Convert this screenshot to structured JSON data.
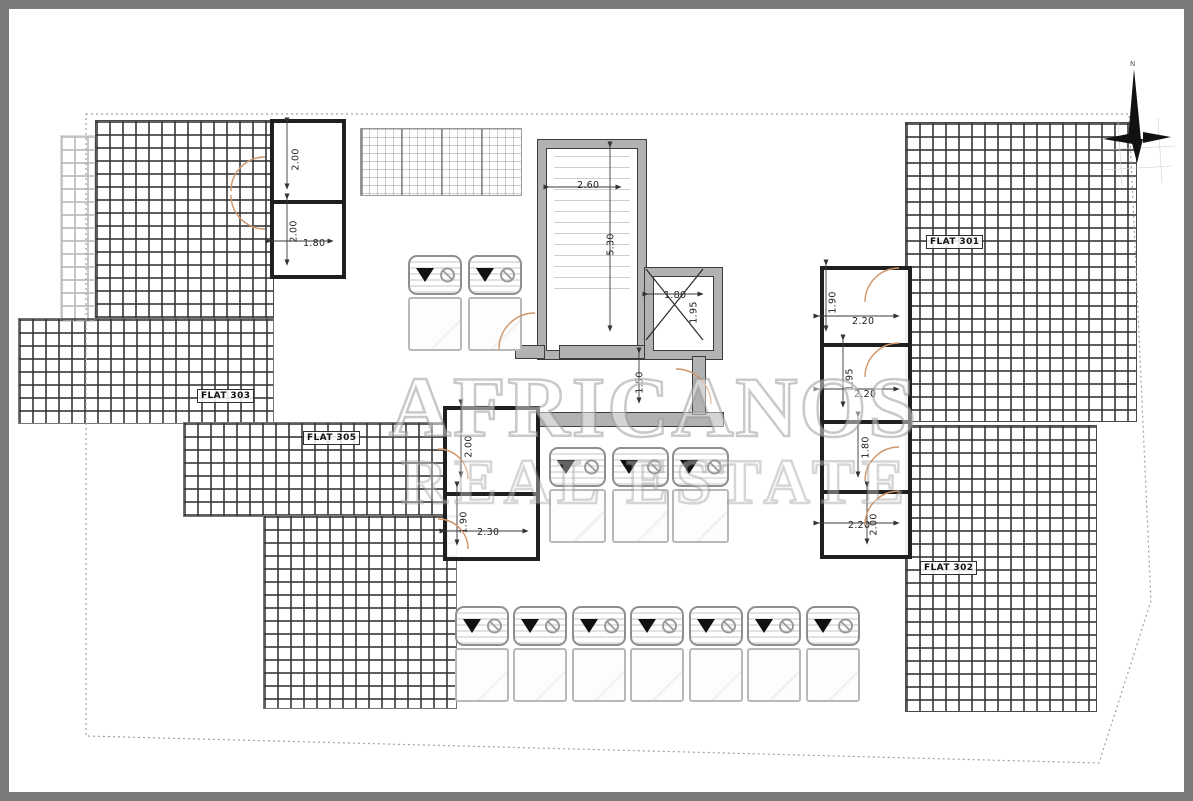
{
  "plan": {
    "flats": {
      "left": "FLAT 303",
      "center": "FLAT 305",
      "top_right": "FLAT 301",
      "bottom_right": "FLAT 302"
    },
    "dims": {
      "tl_room1_h": "2.00",
      "tl_room2_h": "2.00",
      "tl_room2_w": "1.80",
      "stair_w": "2.60",
      "stair_h": "5.30",
      "lift_w": "1.80",
      "lift_h": "1.95",
      "passage": "1.50",
      "mid_room1_h": "2.00",
      "mid_room2_h": "1.90",
      "mid_room2_w": "2.30",
      "r1_h": "1.90",
      "r1_w": "2.20",
      "r2_h": "1.95",
      "r2_w": "2.20",
      "r3_h": "1.80",
      "r4_h": "2.00",
      "r4_w": "2.20"
    },
    "watermark": {
      "line1": "AFRICANOS",
      "line2": "REAL ESTATE"
    },
    "compass": {
      "north": "N"
    },
    "colors": {
      "frame": "#7a7a7a",
      "wall_fill": "#b2b2b2",
      "wall_edge": "#3c3c3c",
      "room_wall": "#1f1f1f",
      "door_arc": "#cf9468",
      "hatch_line": "#3c3c3c",
      "boundary_dots": "#a0a0a0",
      "watermark": "#969696"
    }
  }
}
